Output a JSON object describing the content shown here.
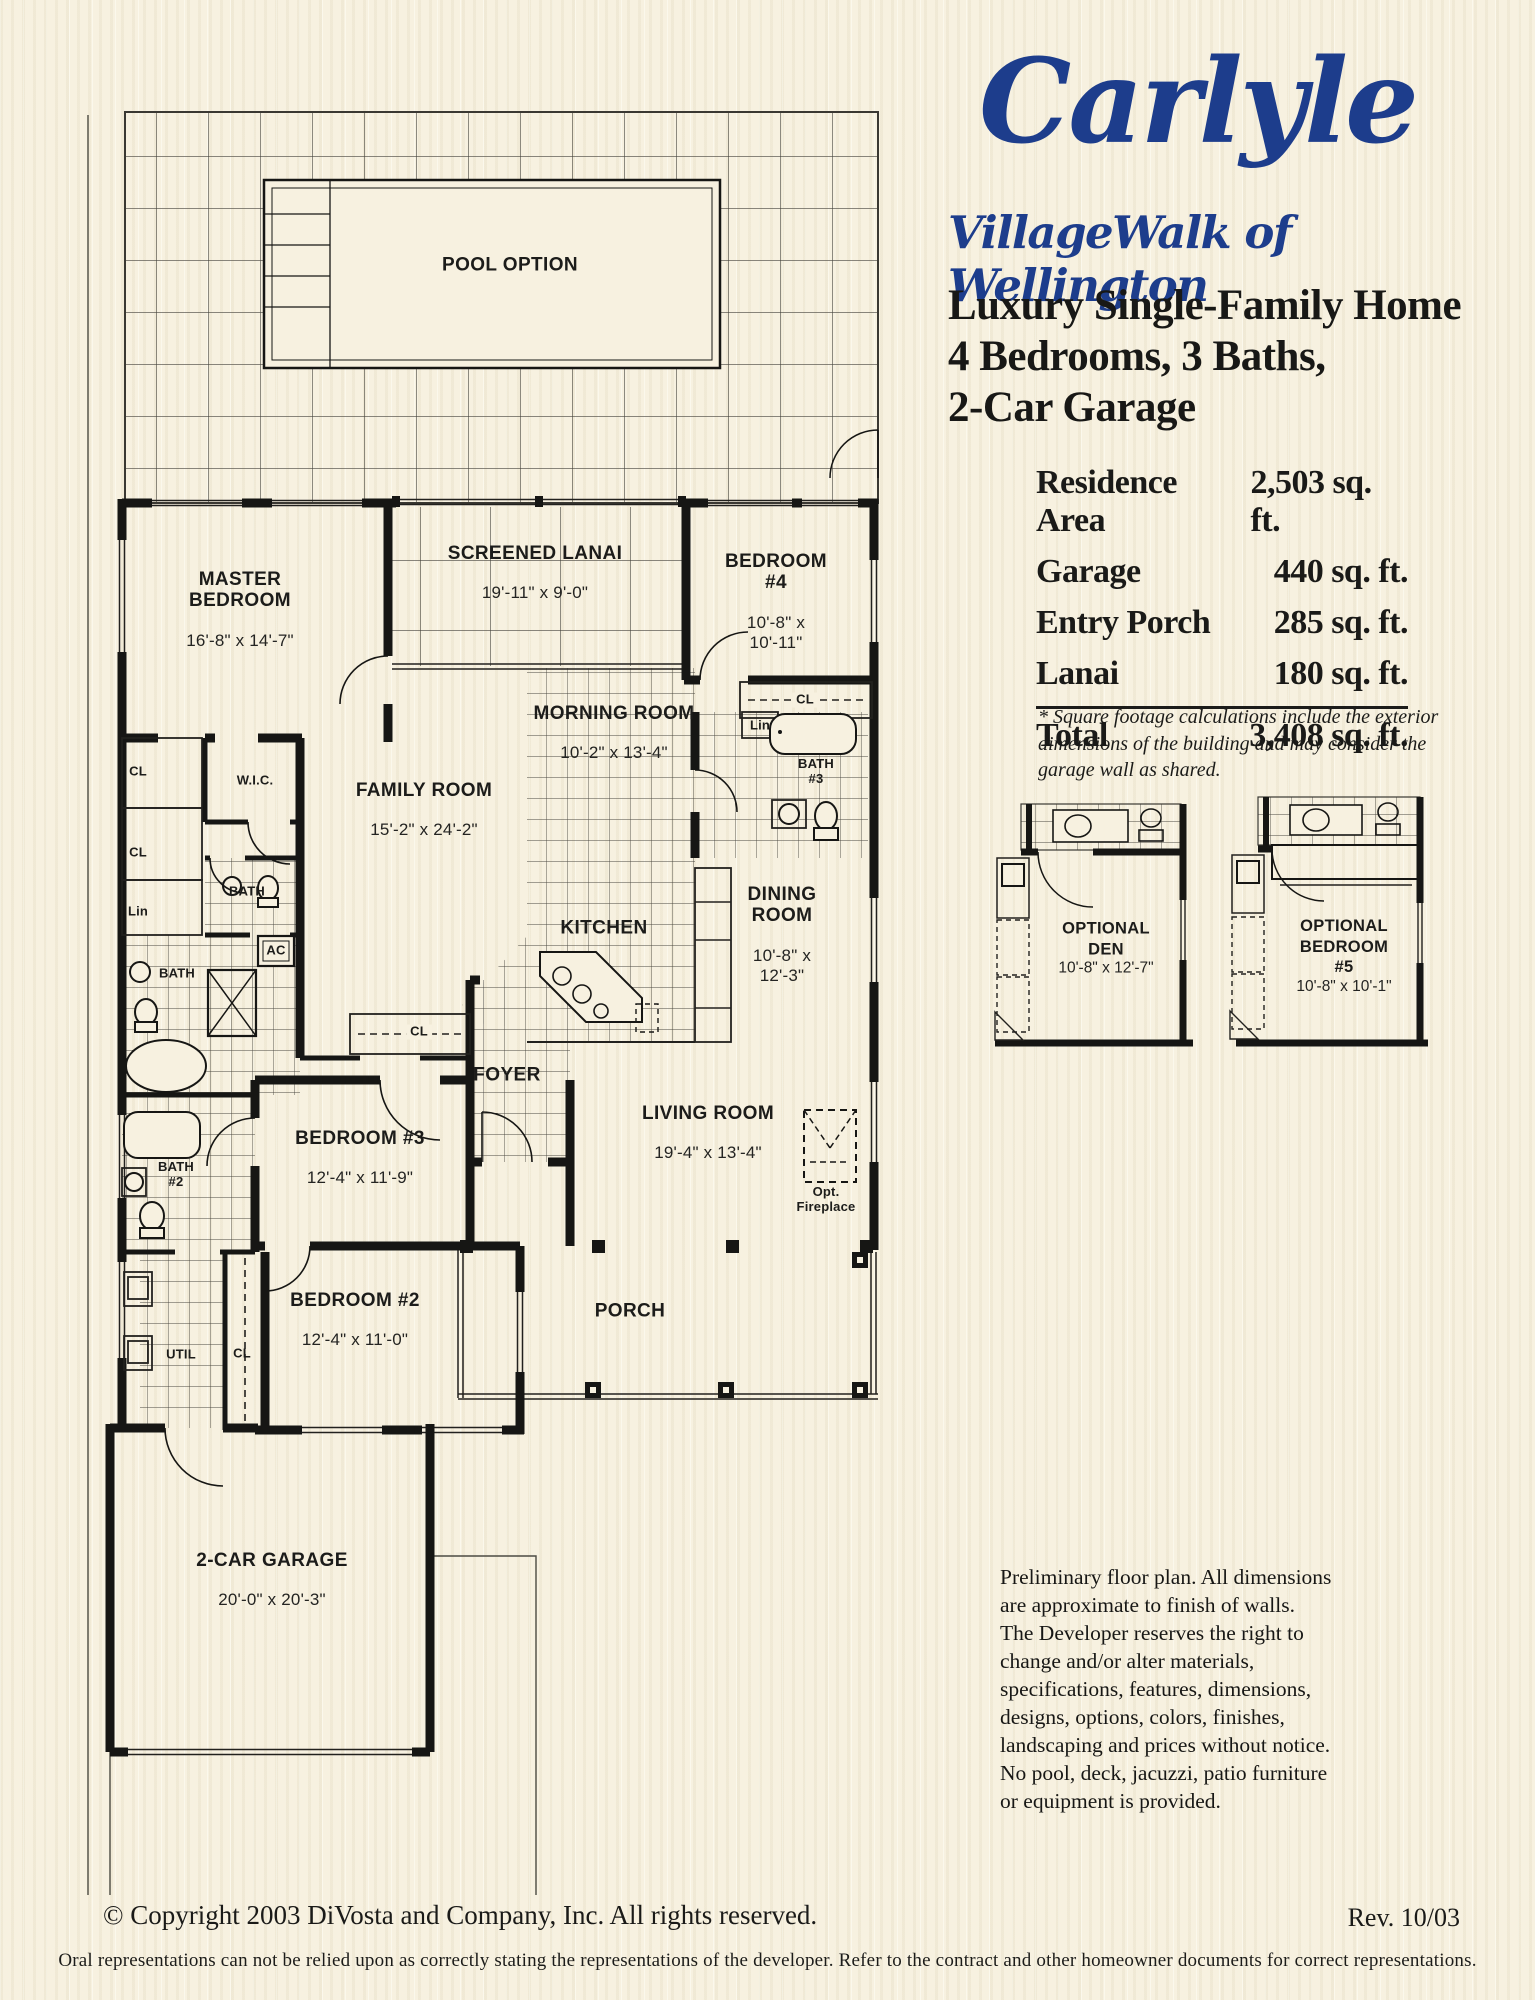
{
  "header": {
    "title": "Carlyle",
    "subtitle": "VillageWalk of Wellington",
    "tagline_line1": "Luxury Single-Family Home",
    "tagline_line2": "4 Bedrooms, 3 Baths,",
    "tagline_line3": "2-Car Garage"
  },
  "area_table": {
    "rows": [
      {
        "label": "Residence Area",
        "value": "2,503 sq. ft."
      },
      {
        "label": "Garage",
        "value": "440 sq. ft."
      },
      {
        "label": "Entry Porch",
        "value": "285 sq. ft."
      },
      {
        "label": "Lanai",
        "value": "180 sq. ft."
      }
    ],
    "total": {
      "label": "Total",
      "value": "3,408 sq. ft."
    }
  },
  "footnote": "* Square footage calculations include the exterior dimensions of the building and may consider the garage wall as shared.",
  "floorplan": {
    "rooms": [
      {
        "name": "POOL OPTION",
        "dims": ""
      },
      {
        "name": "SCREENED LANAI",
        "dims": "19'-11\" x 9'-0\""
      },
      {
        "name": "MASTER\nBEDROOM",
        "dims": "16'-8\" x 14'-7\""
      },
      {
        "name": "BEDROOM #4",
        "dims": "10'-8\" x 10'-11\""
      },
      {
        "name": "MORNING ROOM",
        "dims": "10'-2\" x 13'-4\""
      },
      {
        "name": "FAMILY ROOM",
        "dims": "15'-2\" x 24'-2\""
      },
      {
        "name": "KITCHEN",
        "dims": ""
      },
      {
        "name": "DINING ROOM",
        "dims": "10'-8\" x 12'-3\""
      },
      {
        "name": "FOYER",
        "dims": ""
      },
      {
        "name": "LIVING ROOM",
        "dims": "19'-4\" x 13'-4\""
      },
      {
        "name": "BEDROOM #3",
        "dims": "12'-4\" x 11'-9\""
      },
      {
        "name": "BEDROOM #2",
        "dims": "12'-4\" x 11'-0\""
      },
      {
        "name": "PORCH",
        "dims": ""
      },
      {
        "name": "2-CAR GARAGE",
        "dims": "20'-0\" x 20'-3\""
      }
    ],
    "small_labels": [
      "W.I.C.",
      "CL",
      "CL",
      "Lin",
      "BATH",
      "BATH",
      "AC",
      "CL",
      "Lin",
      "BATH\n#3",
      "BATH\n#2",
      "UTIL",
      "CL",
      "CL",
      "Opt.\nFireplace"
    ]
  },
  "optional_rooms": [
    {
      "title": "OPTIONAL\nDEN",
      "dims": "10'-8\" x 12'-7\""
    },
    {
      "title": "OPTIONAL\nBEDROOM #5",
      "dims": "10'-8\" x 10'-1\""
    }
  ],
  "disclaimer": "Preliminary floor plan. All dimensions are approximate to finish of walls. The Developer reserves the right to change and/or alter materials, specifications, features, dimensions, designs, options, colors, finishes, landscaping and prices without notice. No pool, deck, jacuzzi, patio furniture or equipment is provided.",
  "footer": {
    "copyright": "© Copyright 2003 DiVosta and Company, Inc. All rights reserved.",
    "revision": "Rev. 10/03",
    "fine_print": "Oral representations can not be relied upon as correctly stating the representations of the developer. Refer to the contract and other homeowner documents for correct representations."
  },
  "colors": {
    "brand_blue": "#1d3d8c",
    "paper": "#f7f1e0",
    "ink": "#1b1b18",
    "wall": "#161614"
  }
}
